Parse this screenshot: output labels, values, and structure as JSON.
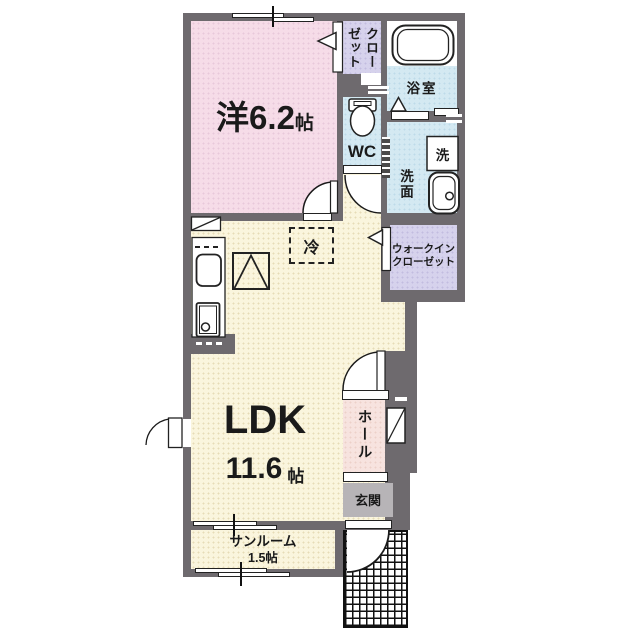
{
  "floorplan": {
    "rooms": {
      "western_room": {
        "label": "洋6.2",
        "unit": "帖"
      },
      "closet": {
        "label": "クローゼット"
      },
      "bathroom": {
        "label": "浴室"
      },
      "toilet_room": {
        "label": "WC"
      },
      "washroom": {
        "label": "洗面"
      },
      "washer": {
        "label": "洗"
      },
      "walk_in_closet": {
        "label": "ウォークイン\nクローゼット"
      },
      "refrigerator": {
        "label": "冷"
      },
      "ldk": {
        "label": "LDK",
        "size": "11.6",
        "unit": "帖"
      },
      "hall": {
        "label": "ホール"
      },
      "entrance": {
        "label": "玄関"
      },
      "sunroom": {
        "label": "サンルーム",
        "size": "1.5帖"
      }
    },
    "colors": {
      "wall": "#6e6a6e",
      "western_room_pink": "#f6dce8",
      "closet_lavender": "#d6d2ec",
      "water_area_blue": "#d4e9f2",
      "ldk_cream": "#faf5dd",
      "hall_pink": "#f7e3df",
      "entrance_gray": "#b7b4b7",
      "text": "#1a1a1a"
    }
  }
}
